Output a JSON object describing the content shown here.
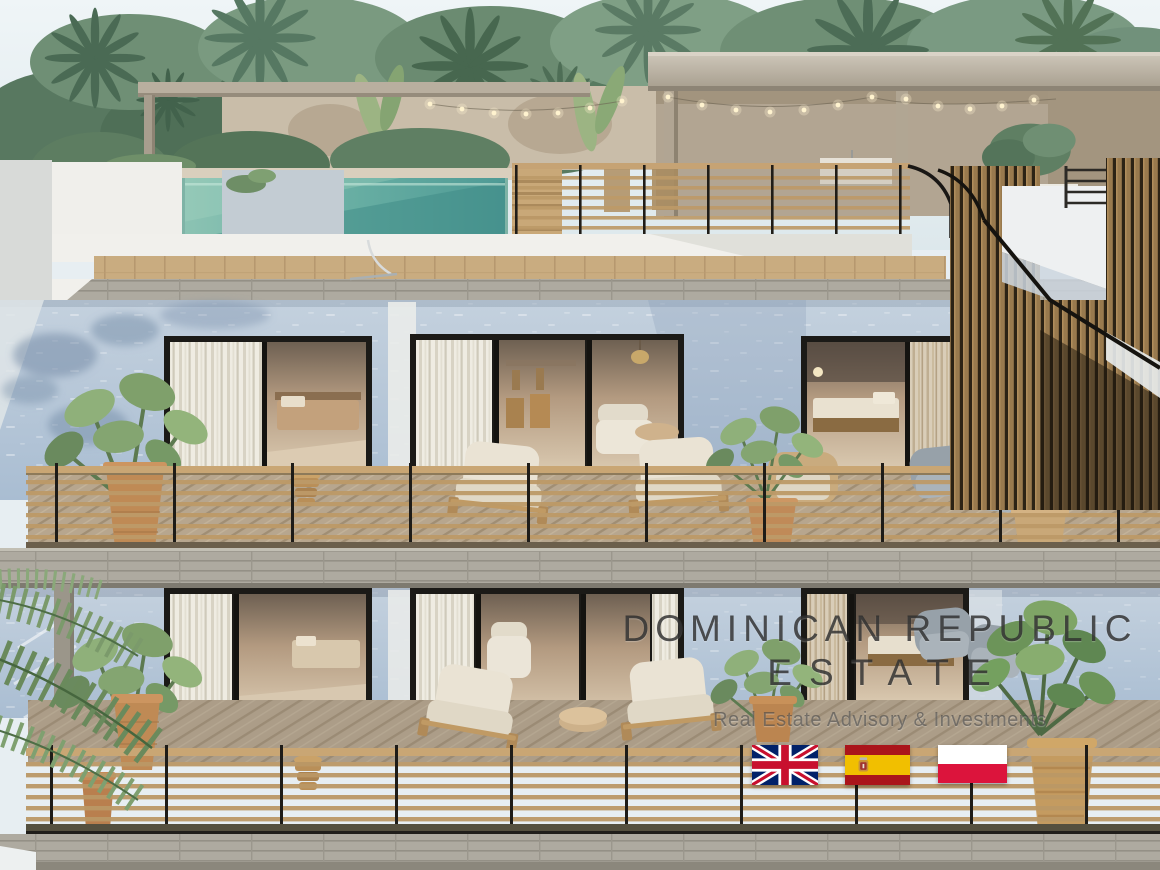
{
  "watermark": {
    "line1": "DOMINICAN REPUBLIC",
    "line2": "ESTATE",
    "tagline": "Real Estate Advisory & Investments"
  },
  "flags": {
    "items": [
      {
        "icon": "uk-flag-icon",
        "country": "United Kingdom"
      },
      {
        "icon": "spain-flag-icon",
        "country": "Spain"
      },
      {
        "icon": "poland-flag-icon",
        "country": "Poland"
      }
    ]
  },
  "colors": {
    "sky": "#e8eff3",
    "pool_teal": "#5fa89d",
    "wall_blue": "#b3c4d6",
    "deck_wood": "#b7a68e",
    "railing_wood": "#bd9a68",
    "watermark_text": "#333333",
    "flag_uk_blue": "#012169",
    "flag_uk_red": "#C8102E",
    "flag_spain_red": "#AA151B",
    "flag_spain_yellow": "#F1BF00",
    "flag_poland_red": "#DC143C"
  }
}
